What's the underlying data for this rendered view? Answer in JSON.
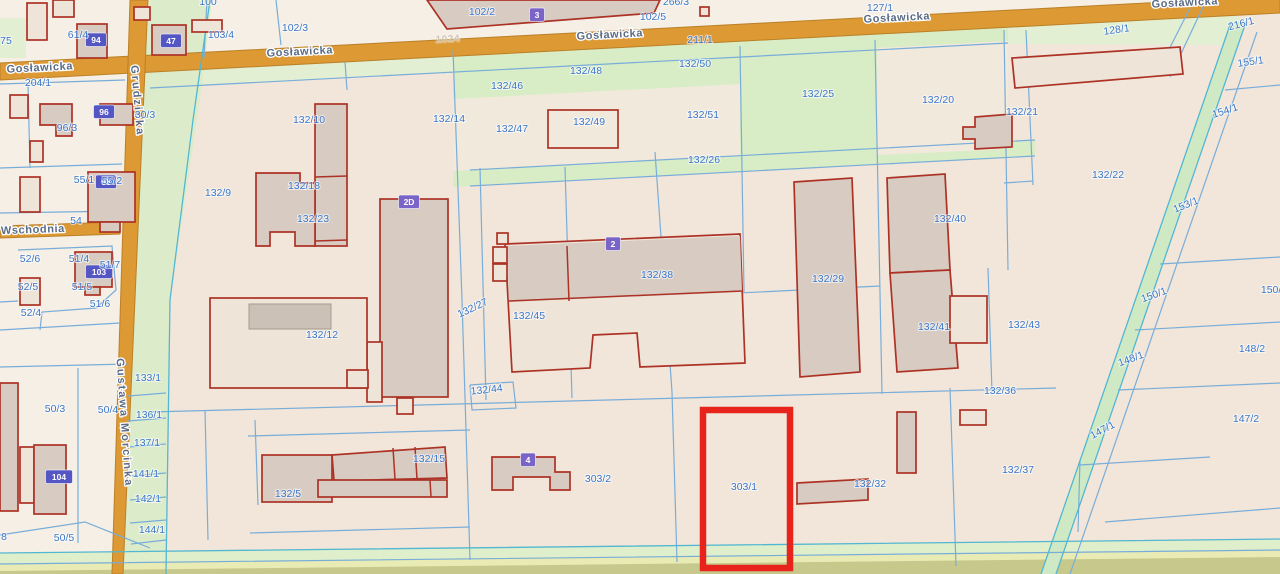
{
  "map_type": "cadastral-parcel-map",
  "selection": {
    "parcel_id": "303/1",
    "outline_color": "#e7231c"
  },
  "colors": {
    "road": "#dc9934",
    "parcel_line": "#79add9",
    "water_line": "#52b7d2",
    "parcel_label": "#3b76c8",
    "building_outline": "#ad3226",
    "building_fill": "#d7cbc2",
    "green_area": "#d8ecc6",
    "selection": "#e7231c",
    "address_badge": "#5456c4",
    "building_badge": "#7a64c8"
  },
  "streets": [
    {
      "text": "Gosławicka",
      "x": 40,
      "y": 71,
      "rot": -3
    },
    {
      "text": "Gosławicka",
      "x": 300,
      "y": 55,
      "rot": -3
    },
    {
      "text": "Gosławicka",
      "x": 610,
      "y": 38,
      "rot": -3
    },
    {
      "text": "Gosławicka",
      "x": 897,
      "y": 21,
      "rot": -3
    },
    {
      "text": "Gosławicka",
      "x": 1185,
      "y": 6,
      "rot": -3
    },
    {
      "text": "Wschodnia",
      "x": 33,
      "y": 233,
      "rot": -2
    },
    {
      "text": "Grudzicka",
      "x": 134,
      "y": 101,
      "rot": 85,
      "cls": "vert"
    },
    {
      "text": "Gustawa Morcinka",
      "x": 121,
      "y": 423,
      "rot": 86,
      "cls": "vert"
    },
    {
      "text": "1024",
      "x": 448,
      "y": 42,
      "rot": -3,
      "cls": "road-number"
    }
  ],
  "parcel_labels": [
    {
      "text": "75",
      "x": 6,
      "y": 44
    },
    {
      "text": "204/1",
      "x": 38,
      "y": 86
    },
    {
      "text": "100",
      "x": 208,
      "y": 5
    },
    {
      "text": "61/4",
      "x": 78,
      "y": 38
    },
    {
      "text": "103/4",
      "x": 221,
      "y": 38
    },
    {
      "text": "102/3",
      "x": 295,
      "y": 31
    },
    {
      "text": "102/2",
      "x": 482,
      "y": 15
    },
    {
      "text": "102/5",
      "x": 653,
      "y": 20
    },
    {
      "text": "266/3",
      "x": 676,
      "y": 5
    },
    {
      "text": "127/1",
      "x": 880,
      "y": 11
    },
    {
      "text": "211/1",
      "x": 700,
      "y": 43
    },
    {
      "text": "96/3",
      "x": 67,
      "y": 131
    },
    {
      "text": "30/3",
      "x": 145,
      "y": 118
    },
    {
      "text": "55/1",
      "x": 84,
      "y": 183
    },
    {
      "text": "55/2",
      "x": 112,
      "y": 184
    },
    {
      "text": "54",
      "x": 76,
      "y": 224
    },
    {
      "text": "52/6",
      "x": 30,
      "y": 262
    },
    {
      "text": "51/4",
      "x": 79,
      "y": 262
    },
    {
      "text": "51/7",
      "x": 110,
      "y": 268
    },
    {
      "text": "52/5",
      "x": 28,
      "y": 290
    },
    {
      "text": "51/5",
      "x": 82,
      "y": 290
    },
    {
      "text": "51/6",
      "x": 100,
      "y": 307
    },
    {
      "text": "52/4",
      "x": 31,
      "y": 316
    },
    {
      "text": "50/3",
      "x": 55,
      "y": 412
    },
    {
      "text": "50/4",
      "x": 108,
      "y": 413
    },
    {
      "text": "133/1",
      "x": 148,
      "y": 381
    },
    {
      "text": "136/1",
      "x": 149,
      "y": 418
    },
    {
      "text": "137/1",
      "x": 147,
      "y": 446
    },
    {
      "text": "141/1",
      "x": 146,
      "y": 477
    },
    {
      "text": "142/1",
      "x": 148,
      "y": 502
    },
    {
      "text": "144/1",
      "x": 152,
      "y": 533
    },
    {
      "text": "50/5",
      "x": 64,
      "y": 541
    },
    {
      "text": "8",
      "x": 4,
      "y": 540
    },
    {
      "text": "132/9",
      "x": 218,
      "y": 196
    },
    {
      "text": "132/10",
      "x": 309,
      "y": 123
    },
    {
      "text": "132/14",
      "x": 449,
      "y": 122
    },
    {
      "text": "132/18",
      "x": 304,
      "y": 189
    },
    {
      "text": "132/23",
      "x": 313,
      "y": 222
    },
    {
      "text": "132/12",
      "x": 322,
      "y": 338
    },
    {
      "text": "132/27",
      "x": 474,
      "y": 311,
      "rot": -25
    },
    {
      "text": "132/45",
      "x": 529,
      "y": 319
    },
    {
      "text": "132/38",
      "x": 657,
      "y": 278
    },
    {
      "text": "132/44",
      "x": 487,
      "y": 393,
      "rot": -6
    },
    {
      "text": "132/48",
      "x": 586,
      "y": 74
    },
    {
      "text": "132/50",
      "x": 695,
      "y": 67
    },
    {
      "text": "132/46",
      "x": 507,
      "y": 89
    },
    {
      "text": "132/47",
      "x": 512,
      "y": 132
    },
    {
      "text": "132/49",
      "x": 589,
      "y": 125
    },
    {
      "text": "132/51",
      "x": 703,
      "y": 118
    },
    {
      "text": "132/25",
      "x": 818,
      "y": 97
    },
    {
      "text": "132/26",
      "x": 704,
      "y": 163
    },
    {
      "text": "132/20",
      "x": 938,
      "y": 103
    },
    {
      "text": "132/21",
      "x": 1022,
      "y": 115
    },
    {
      "text": "132/22",
      "x": 1108,
      "y": 178
    },
    {
      "text": "132/29",
      "x": 828,
      "y": 282
    },
    {
      "text": "132/40",
      "x": 950,
      "y": 222
    },
    {
      "text": "132/41",
      "x": 934,
      "y": 330
    },
    {
      "text": "132/43",
      "x": 1024,
      "y": 328
    },
    {
      "text": "132/36",
      "x": 1000,
      "y": 394
    },
    {
      "text": "132/37",
      "x": 1018,
      "y": 473
    },
    {
      "text": "132/5",
      "x": 288,
      "y": 497
    },
    {
      "text": "132/15",
      "x": 429,
      "y": 462
    },
    {
      "text": "303/2",
      "x": 598,
      "y": 482
    },
    {
      "text": "303/1",
      "x": 744,
      "y": 490
    },
    {
      "text": "132/32",
      "x": 870,
      "y": 487
    },
    {
      "text": "128/1",
      "x": 1117,
      "y": 33,
      "rot": -8
    },
    {
      "text": "216/1",
      "x": 1242,
      "y": 27,
      "rot": -15
    },
    {
      "text": "155/1",
      "x": 1251,
      "y": 65,
      "rot": -8
    },
    {
      "text": "154/1",
      "x": 1226,
      "y": 114,
      "rot": -18
    },
    {
      "text": "153/1",
      "x": 1187,
      "y": 208,
      "rot": -22
    },
    {
      "text": "150/1",
      "x": 1155,
      "y": 298,
      "rot": -20
    },
    {
      "text": "150/2",
      "x": 1274,
      "y": 293
    },
    {
      "text": "148/1",
      "x": 1132,
      "y": 362,
      "rot": -20
    },
    {
      "text": "148/2",
      "x": 1252,
      "y": 352
    },
    {
      "text": "147/1",
      "x": 1104,
      "y": 433,
      "rot": -28
    },
    {
      "text": "147/2",
      "x": 1246,
      "y": 422
    }
  ],
  "address_badges": [
    {
      "text": "94",
      "x": 96,
      "y": 40
    },
    {
      "text": "47",
      "x": 171,
      "y": 41
    },
    {
      "text": "96",
      "x": 104,
      "y": 112
    },
    {
      "text": "98",
      "x": 106,
      "y": 182
    },
    {
      "text": "103",
      "x": 99,
      "y": 272
    },
    {
      "text": "104",
      "x": 59,
      "y": 477
    }
  ],
  "building_badges": [
    {
      "text": "3",
      "x": 537,
      "y": 15
    },
    {
      "text": "2",
      "x": 613,
      "y": 244
    },
    {
      "text": "2D",
      "x": 409,
      "y": 202
    },
    {
      "text": "4",
      "x": 528,
      "y": 460
    }
  ]
}
